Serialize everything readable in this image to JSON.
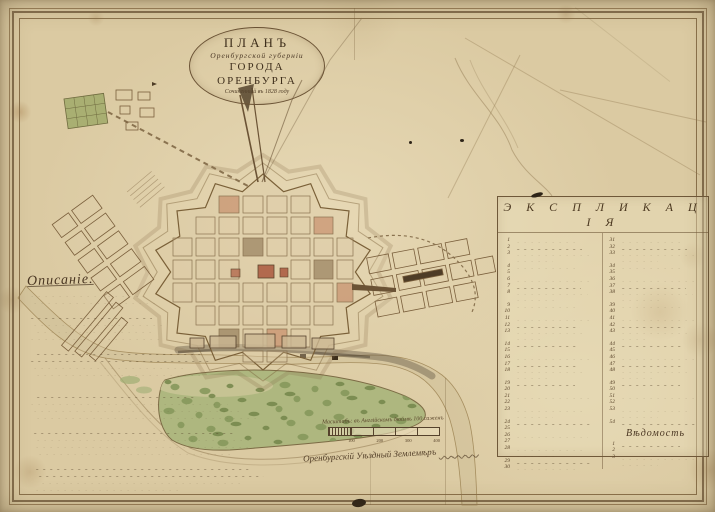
{
  "title": {
    "line1": "ПЛАНЪ",
    "line2": "Оренбургской губерніи",
    "line3": "ГОРОДА ОРЕНБУРГА",
    "line4": "Сочиненный въ 1828 году"
  },
  "description": {
    "header": "Описаніе."
  },
  "explication": {
    "header": "Э К С П Л И К А Ц І Я",
    "left_numbers": [
      "1",
      "2",
      "3",
      "4",
      "5",
      "6",
      "7",
      "8",
      "9",
      "10",
      "11",
      "12",
      "13",
      "14",
      "15",
      "16",
      "17",
      "18",
      "19",
      "20",
      "21",
      "22",
      "23",
      "24",
      "25",
      "26",
      "27",
      "28",
      "29",
      "30"
    ],
    "right_numbers": [
      "31",
      "32",
      "33",
      "34",
      "35",
      "36",
      "37",
      "38",
      "39",
      "40",
      "41",
      "42",
      "43",
      "44",
      "45",
      "46",
      "47",
      "48",
      "49",
      "50",
      "51",
      "52",
      "53",
      "54"
    ],
    "vedomost_header": "Вѣдомость",
    "vedomost_numbers": [
      "1",
      "2",
      "3"
    ]
  },
  "scale_bar": {
    "caption": "Масштабъ: въ Англійскомъ дюймѣ 100 саженъ",
    "ticks": [
      "100",
      "200",
      "300",
      "400"
    ]
  },
  "signature": "Оренбургскій Уѣздный Землемѣръ",
  "colors": {
    "paper": "#d9c8a0",
    "ink": "#4a3a22",
    "faded_ink": "#8a7350",
    "building_red": "#b26a4e",
    "island_green": "#aeb77f",
    "tree_green": "#7d9055",
    "river_wash": "#cdbd96"
  }
}
